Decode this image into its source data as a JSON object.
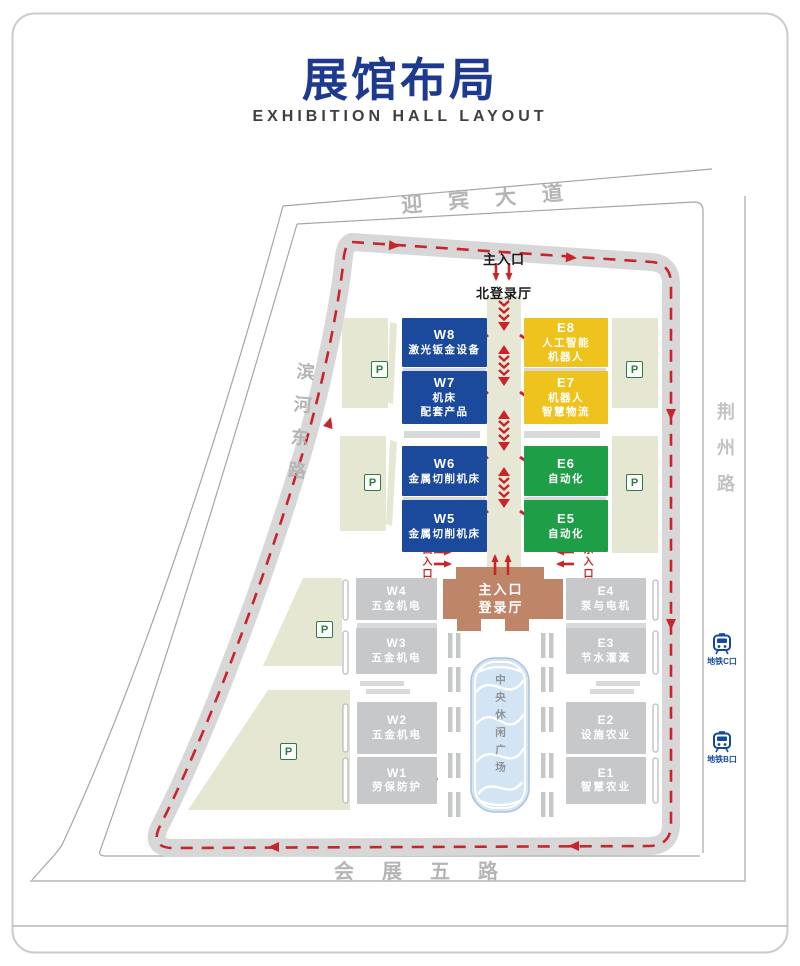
{
  "header": {
    "title": "展馆布局",
    "subtitle": "EXHIBITION HALL LAYOUT"
  },
  "roads": {
    "north": "迎宾大道",
    "west": "滨河东路",
    "east": "荆州路",
    "south": "会展五路"
  },
  "entrances": {
    "main_north": "主入口",
    "north_hall": "北登录厅",
    "west": "西入口",
    "east": "东入口",
    "main_hall_line1": "主入口",
    "main_hall_line2": "登录厅"
  },
  "halls": {
    "w8": {
      "code": "W8",
      "line1": "激光钣金设备"
    },
    "w7": {
      "code": "W7",
      "line1": "机床",
      "line2": "配套产品"
    },
    "e8": {
      "code": "E8",
      "line1": "人工智能",
      "line2": "机器人"
    },
    "e7": {
      "code": "E7",
      "line1": "机器人",
      "line2": "智慧物流"
    },
    "w6": {
      "code": "W6",
      "line1": "金属切削机床"
    },
    "w5": {
      "code": "W5",
      "line1": "金属切削机床"
    },
    "e6": {
      "code": "E6",
      "line1": "自动化"
    },
    "e5": {
      "code": "E5",
      "line1": "自动化"
    },
    "w4": {
      "code": "W4",
      "line1": "五金机电"
    },
    "w3": {
      "code": "W3",
      "line1": "五金机电"
    },
    "w2": {
      "code": "W2",
      "line1": "五金机电"
    },
    "w1": {
      "code": "W1",
      "line1": "劳保防护"
    },
    "e4": {
      "code": "E4",
      "line1": "泵与电机"
    },
    "e3": {
      "code": "E3",
      "line1": "节水灌溉"
    },
    "e2": {
      "code": "E2",
      "line1": "设施农业"
    },
    "e1": {
      "code": "E1",
      "line1": "智慧农业"
    }
  },
  "plaza": {
    "label": "中央休闲广场"
  },
  "parking": {
    "label": "P"
  },
  "metro": {
    "c": "地铁C口",
    "b": "地铁B口"
  },
  "icons": {
    "parking": "parking-square",
    "metro": "train-icon",
    "route": "red-dashed-arrow"
  },
  "colors": {
    "title_blue": "#1e3a8f",
    "hall_blue": "#1b4a9c",
    "hall_yellow": "#efc31e",
    "hall_green": "#1f9e48",
    "hall_gray": "#c7c8ca",
    "hall_brown": "#bf8568",
    "route_red": "#c8242a",
    "ring_road_gray": "#d7d7d7",
    "park_green": "#e5e7d3",
    "plaza_blue": "#d3e4f5",
    "marker_yellow": "#f2e41f",
    "marker_orange": "#e8871e",
    "metro_blue": "#12499c"
  }
}
